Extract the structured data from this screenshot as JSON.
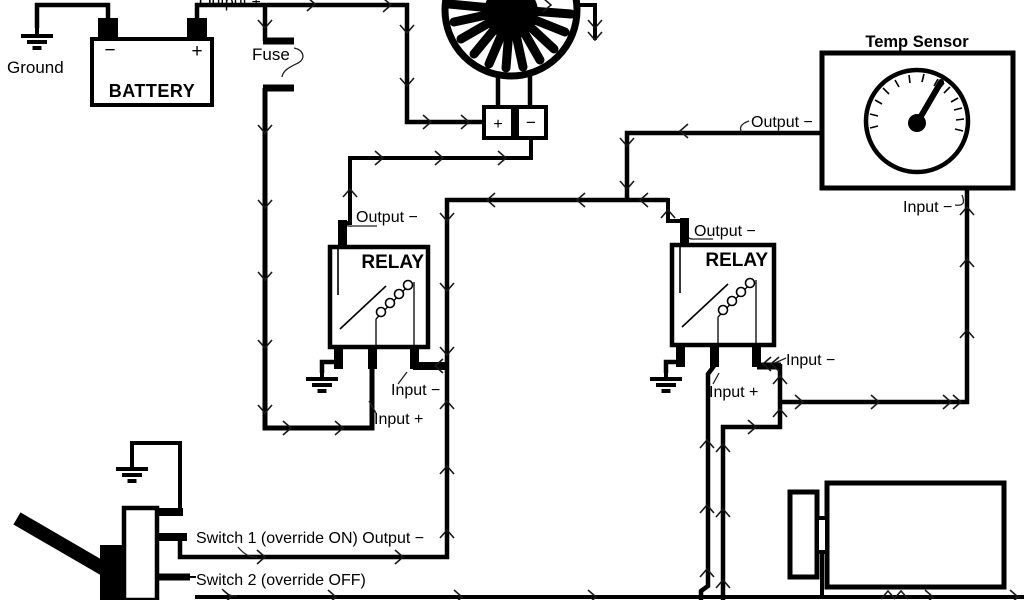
{
  "diagram": {
    "background": "#ffffff",
    "line_color": "#000000",
    "ground_label": "Ground",
    "battery": {
      "title": "BATTERY",
      "neg_terminal": "−",
      "pos_terminal": "+",
      "output_label": "Output +"
    },
    "fuse_label": "Fuse",
    "fan": {
      "pos_terminal": "+",
      "neg_terminal": "−"
    },
    "relay1": {
      "title": "RELAY",
      "output_label": "Output −",
      "input_neg_label": "Input −",
      "input_pos_label": "Input +"
    },
    "relay2": {
      "title": "RELAY",
      "output_label": "Output −",
      "input_neg_label": "Input −",
      "input_pos_label": "Input +"
    },
    "temp_sensor": {
      "title": "Temp Sensor",
      "output_label": "Output −",
      "input_label": "Input −"
    },
    "switches": {
      "switch1_label": "Switch 1 (override ON) Output −",
      "switch2_label": "Switch 2 (override OFF)"
    }
  }
}
